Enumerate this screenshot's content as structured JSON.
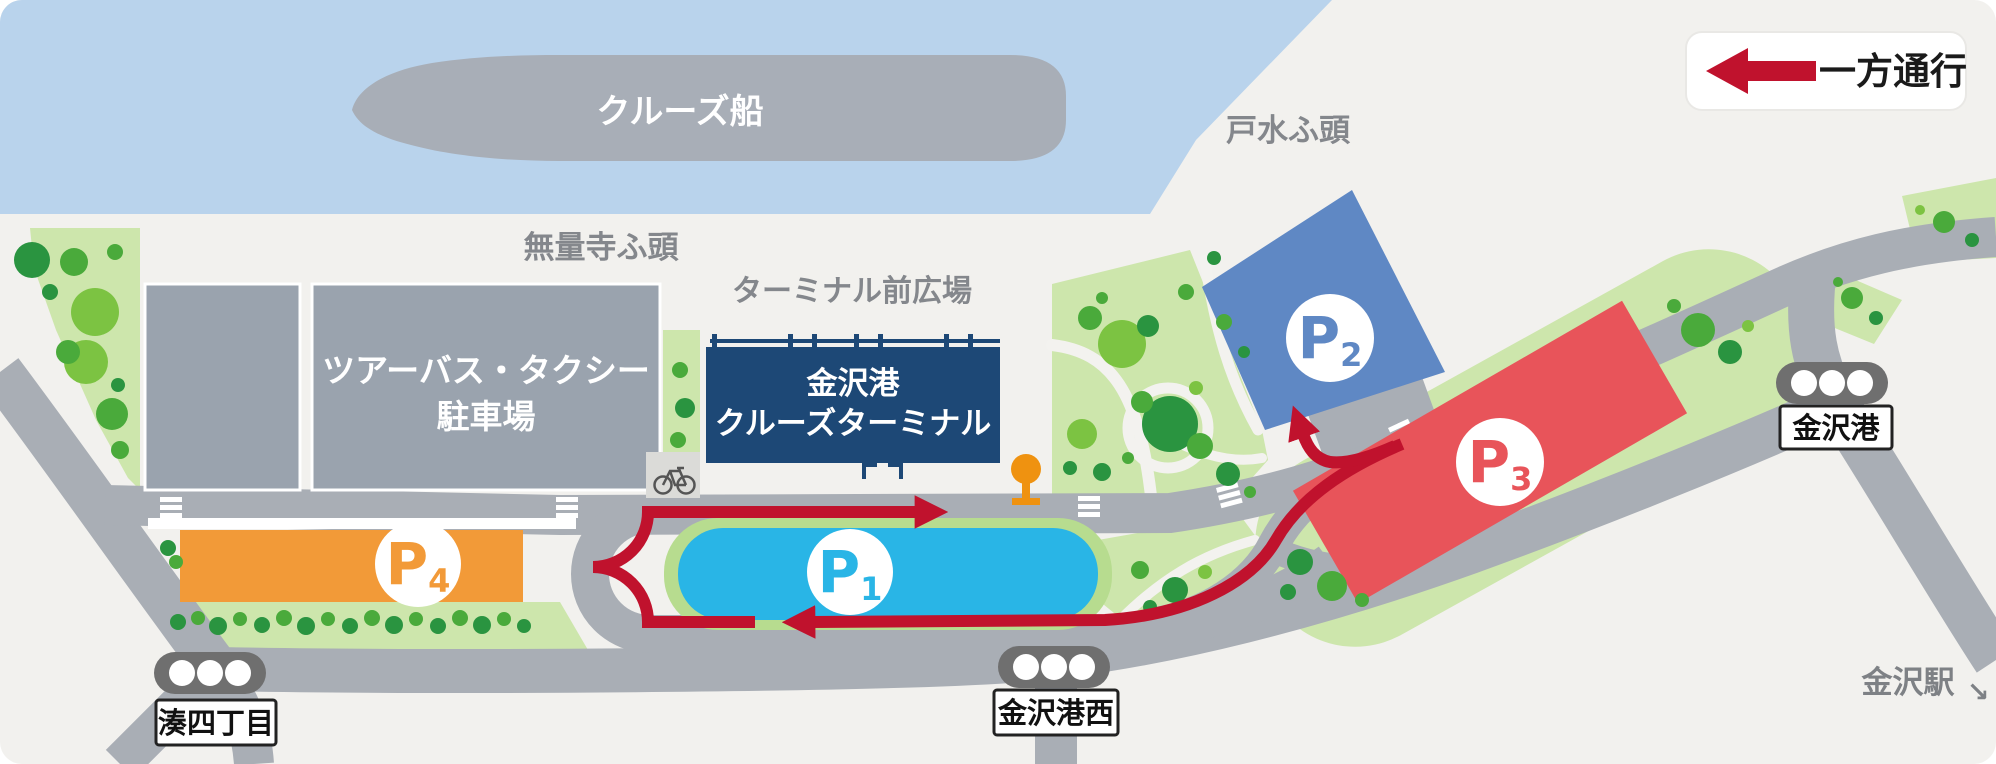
{
  "legend": {
    "one_way_label": "一方通行"
  },
  "water_labels": {
    "cruise_ship": "クルーズ船"
  },
  "area_labels": {
    "tomizu_pier": "戸水ふ頭",
    "muryoji_pier": "無量寺ふ頭",
    "terminal_plaza": "ターミナル前広場",
    "kanazawa_station": "金沢駅",
    "kanazawa_station_arrow": "↘"
  },
  "buildings": {
    "terminal": {
      "line1": "金沢港",
      "line2": "クルーズターミナル"
    },
    "bus_taxi": {
      "line1": "ツアーバス・タクシー",
      "line2": "駐車場"
    }
  },
  "parkings": [
    {
      "letter": "P",
      "number": "1",
      "color": "#29b5e6"
    },
    {
      "letter": "P",
      "number": "2",
      "color": "#5f88c4"
    },
    {
      "letter": "P",
      "number": "3",
      "color": "#e8545a"
    },
    {
      "letter": "P",
      "number": "4",
      "color": "#f29a38"
    }
  ],
  "signals": [
    {
      "label": "金沢港"
    },
    {
      "label": "湊四丁目"
    },
    {
      "label": "金沢港西"
    }
  ],
  "colors": {
    "water": "#b9d3ec",
    "land": "#f2f1ee",
    "road": "#a9aeb5",
    "building_gray": "#9aa3ae",
    "ship_gray": "#a8aeb7",
    "terminal_navy": "#1d4876",
    "one_way_red": "#c0122d",
    "green_area": "#cde6ac"
  }
}
